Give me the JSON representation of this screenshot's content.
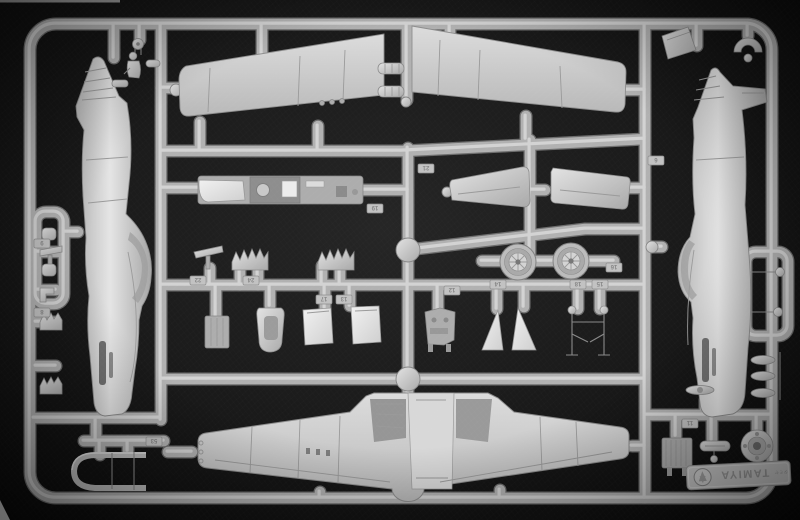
{
  "scene": {
    "type": "photograph",
    "subject": "Injection-molded model kit sprue (parts tree) with P-51 Mustang aircraft parts in light grey styrene, photographed on a dark textured background"
  },
  "branding": {
    "brand": "TAMIYA",
    "detail_text": "タミヤ",
    "logo_icon": "tamiya-roundel-logo",
    "orientation": "upside-down"
  },
  "colors": {
    "background": "#161616",
    "plastic": "#c4c4c4",
    "plastic_highlight": "#e9e9e9",
    "plastic_shadow": "#8f8f8f",
    "recess": "#6f6f6f"
  },
  "part_tags": [
    "16",
    "24",
    "13",
    "17",
    "22",
    "14",
    "19",
    "12",
    "18",
    "15",
    "21",
    "53",
    "9",
    "8",
    "6",
    "11"
  ]
}
